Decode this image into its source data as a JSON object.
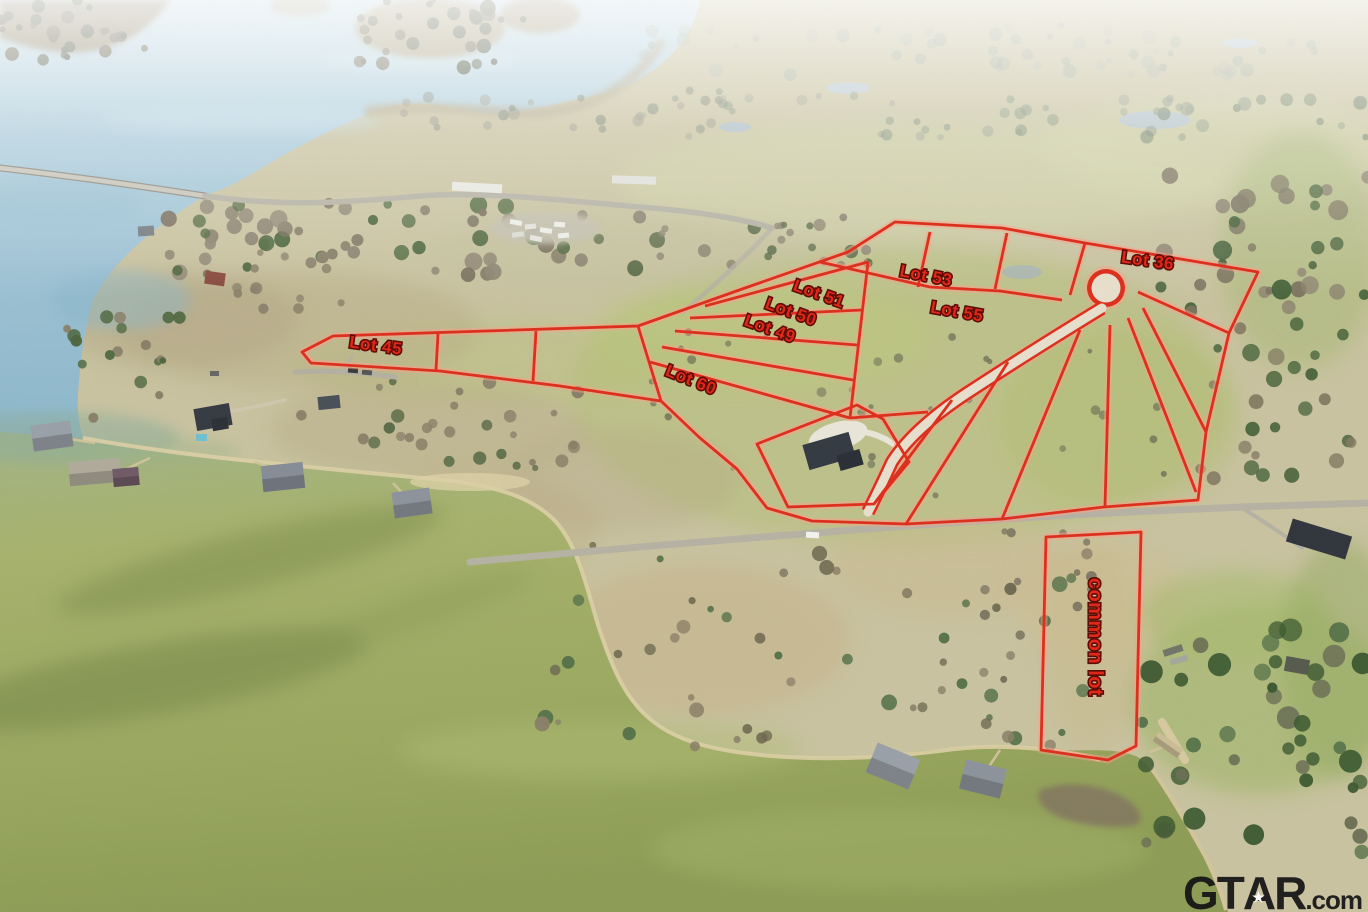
{
  "plat": {
    "line_color": "#dd2f1d",
    "halo_color": "#ff9d8a",
    "road_fill": "#e7dfcc",
    "label_color": "#e02616",
    "label_outline": "#5c0a04",
    "label_size": 17,
    "outer": [
      [
        302,
        352
      ],
      [
        333,
        336
      ],
      [
        638,
        326
      ],
      [
        745,
        288
      ],
      [
        848,
        252
      ],
      [
        895,
        222
      ],
      [
        1002,
        228
      ],
      [
        1085,
        243
      ],
      [
        1258,
        272
      ],
      [
        1229,
        333
      ],
      [
        1206,
        432
      ],
      [
        1198,
        500
      ],
      [
        1104,
        507
      ],
      [
        1002,
        519
      ],
      [
        906,
        524
      ],
      [
        812,
        521
      ],
      [
        767,
        508
      ],
      [
        737,
        469
      ],
      [
        700,
        438
      ],
      [
        661,
        401
      ],
      [
        560,
        386
      ],
      [
        440,
        371
      ],
      [
        311,
        363
      ]
    ],
    "inner_lines": [
      [
        [
          438,
          334
        ],
        [
          436,
          370
        ]
      ],
      [
        [
          536,
          331
        ],
        [
          533,
          381
        ]
      ],
      [
        [
          638,
          326
        ],
        [
          661,
          401
        ]
      ],
      [
        [
          820,
          262
        ],
        [
          930,
          287
        ],
        [
          1000,
          291
        ],
        [
          1062,
          300
        ]
      ],
      [
        [
          930,
          232
        ],
        [
          918,
          287
        ]
      ],
      [
        [
          1007,
          233
        ],
        [
          995,
          289
        ]
      ],
      [
        [
          1085,
          243
        ],
        [
          1070,
          295
        ]
      ],
      [
        [
          705,
          306
        ],
        [
          868,
          262
        ]
      ],
      [
        [
          690,
          318
        ],
        [
          862,
          310
        ]
      ],
      [
        [
          675,
          331
        ],
        [
          857,
          345
        ]
      ],
      [
        [
          662,
          347
        ],
        [
          853,
          380
        ]
      ],
      [
        [
          650,
          362
        ],
        [
          850,
          418
        ]
      ],
      [
        [
          868,
          262
        ],
        [
          850,
          418
        ]
      ],
      [
        [
          850,
          418
        ],
        [
          928,
          412
        ]
      ],
      [
        [
          1138,
          292
        ],
        [
          1229,
          333
        ]
      ],
      [
        [
          1143,
          308
        ],
        [
          1206,
          432
        ]
      ],
      [
        [
          1128,
          318
        ],
        [
          1196,
          492
        ]
      ],
      [
        [
          1110,
          325
        ],
        [
          1105,
          506
        ]
      ],
      [
        [
          1080,
          330
        ],
        [
          1002,
          519
        ]
      ],
      [
        [
          1008,
          362
        ],
        [
          906,
          524
        ]
      ],
      [
        [
          952,
          400
        ],
        [
          874,
          504
        ]
      ]
    ],
    "house_lot": [
      [
        757,
        444
      ],
      [
        857,
        405
      ],
      [
        883,
        419
      ],
      [
        909,
        462
      ],
      [
        874,
        504
      ],
      [
        788,
        507
      ]
    ],
    "common_lot": [
      [
        1046,
        537
      ],
      [
        1141,
        532
      ],
      [
        1136,
        746
      ],
      [
        1108,
        760
      ],
      [
        1041,
        750
      ]
    ],
    "road_path": "M 1102,308 Q 1030,352 975,388 Q 915,426 892,462 Q 880,488 868,512",
    "culdesac": {
      "cx": 1106,
      "cy": 288,
      "r": 19
    },
    "lots": [
      {
        "label": "Lot 45",
        "x": 375,
        "y": 351,
        "rot": 8
      },
      {
        "label": "Lot 51",
        "x": 817,
        "y": 299,
        "rot": 20
      },
      {
        "label": "Lot 50",
        "x": 789,
        "y": 317,
        "rot": 20
      },
      {
        "label": "Lot 49",
        "x": 768,
        "y": 334,
        "rot": 20
      },
      {
        "label": "Lot 53",
        "x": 925,
        "y": 281,
        "rot": 11
      },
      {
        "label": "Lot 55",
        "x": 956,
        "y": 317,
        "rot": 10
      },
      {
        "label": "Lot 36",
        "x": 1147,
        "y": 266,
        "rot": 8
      },
      {
        "label": "Lot 60",
        "x": 689,
        "y": 385,
        "rot": 22
      },
      {
        "label": "common lot",
        "x": 1089,
        "y": 637,
        "rot": 90,
        "size": 20
      }
    ]
  },
  "watermark": {
    "brand_pre": "GT",
    "brand_a": "A",
    "brand_post": "R",
    "suffix": ".com",
    "star": "★",
    "color": "#161616"
  }
}
